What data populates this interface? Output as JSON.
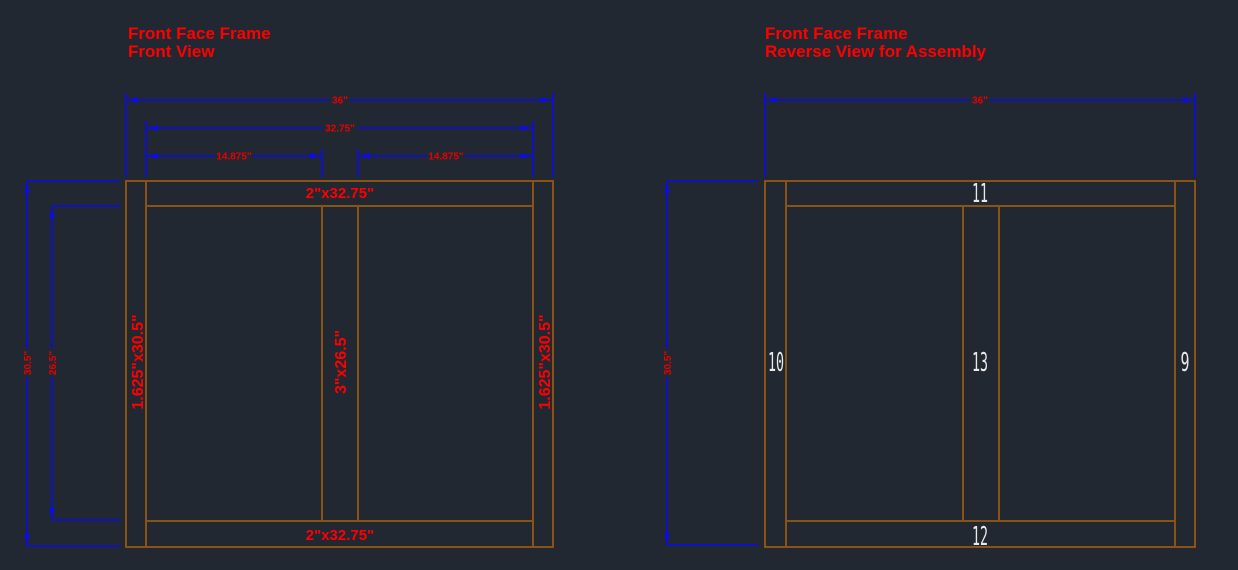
{
  "colors": {
    "background": "#222831",
    "frame": "#8a5315",
    "dimension_line": "#0b0bee",
    "dimension_text": "#e60000",
    "label_text": "#ff0000",
    "part_number_text": "#e9e9e9",
    "title_text": "#ff0000"
  },
  "left_view": {
    "title_line1": "Front Face Frame",
    "title_line2": "Front View",
    "dimensions": {
      "overall_width": "36\"",
      "inner_width": "32.75\"",
      "left_opening_width": "14.875\"",
      "right_opening_width": "14.875\"",
      "overall_height": "30.5\"",
      "inner_height": "26.5\""
    },
    "part_labels": {
      "top_rail": "2\"x32.75\"",
      "bottom_rail": "2\"x32.75\"",
      "left_stile": "1.625\"x30.5\"",
      "center_stile": "3\"x26.5\"",
      "right_stile": "1.625\"x30.5\""
    }
  },
  "right_view": {
    "title_line1": "Front Face Frame",
    "title_line2": "Reverse View for Assembly",
    "dimensions": {
      "overall_width": "36\"",
      "overall_height": "30.5\""
    },
    "part_numbers": {
      "top_rail": "11",
      "left_stile": "10",
      "center_stile": "13",
      "right_stile": "9",
      "bottom_rail": "12"
    }
  }
}
